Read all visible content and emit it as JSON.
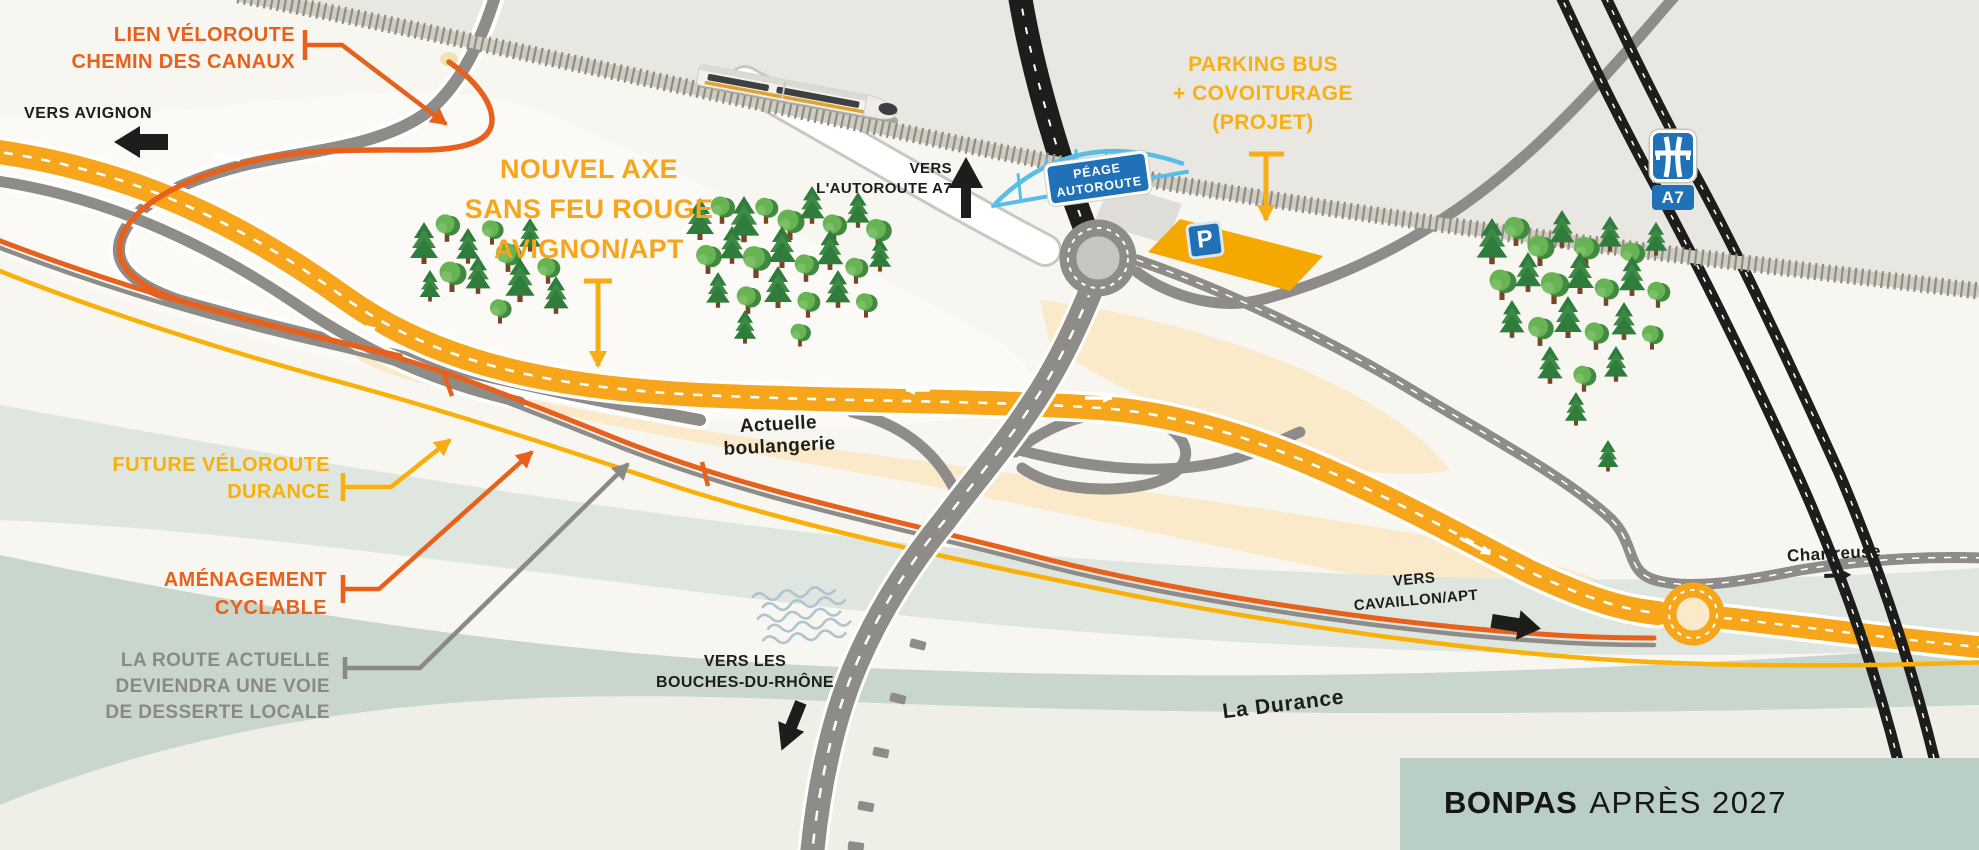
{
  "map": {
    "title_box": {
      "bold": "BONPAS",
      "rest": "APRÈS 2027"
    },
    "labels": {
      "lien_veloroute": {
        "lines": [
          "LIEN VÉLOROUTE",
          "CHEMIN DES CANAUX"
        ]
      },
      "vers_avignon": {
        "text": "VERS AVIGNON"
      },
      "nouvel_axe": {
        "lines": [
          "NOUVEL AXE",
          "SANS FEU ROUGE",
          "AVIGNON/APT"
        ]
      },
      "vers_autoroute": {
        "lines": [
          "VERS",
          "L'AUTOROUTE A7"
        ]
      },
      "parking": {
        "lines": [
          "PARKING BUS",
          "+ COVOITURAGE",
          "(PROJET)"
        ]
      },
      "peage_sign": {
        "lines": [
          "PÉAGE",
          "AUTOROUTE"
        ]
      },
      "a7_sign": {
        "text": "A7"
      },
      "p_sign": {
        "text": "P"
      },
      "actuelle_boulangerie": {
        "lines": [
          "Actuelle",
          "boulangerie"
        ]
      },
      "future_veloroute": {
        "lines": [
          "FUTURE VÉLOROUTE",
          "DURANCE"
        ]
      },
      "amenagement_cyclable": {
        "lines": [
          "AMÉNAGEMENT",
          "CYCLABLE"
        ]
      },
      "route_actuelle": {
        "lines": [
          "LA ROUTE ACTUELLE",
          "DEVIENDRA UNE VOIE",
          "DE DESSERTE LOCALE"
        ]
      },
      "vers_bouches": {
        "lines": [
          "VERS LES",
          "BOUCHES-DU-RHÔNE"
        ]
      },
      "vers_cavaillon": {
        "lines": [
          "VERS",
          "CAVAILLON/APT"
        ]
      },
      "chartreuse": {
        "text": "Chartreuse"
      },
      "la_durance": {
        "text": "La Durance"
      }
    },
    "colors": {
      "main_road_yellow": "#F7A61B",
      "veloroute_orange": "#E8611C",
      "veloroute_yellow": "#F9B008",
      "local_road_gray": "#8D8C88",
      "motorway_black": "#1D1D1B",
      "sign_blue": "#2171B7",
      "bridge_blue": "#58BEE7",
      "river_sage": "#C9D6CD",
      "cream_area": "#FAEACA",
      "title_box_bg": "#B9CEC4"
    }
  }
}
